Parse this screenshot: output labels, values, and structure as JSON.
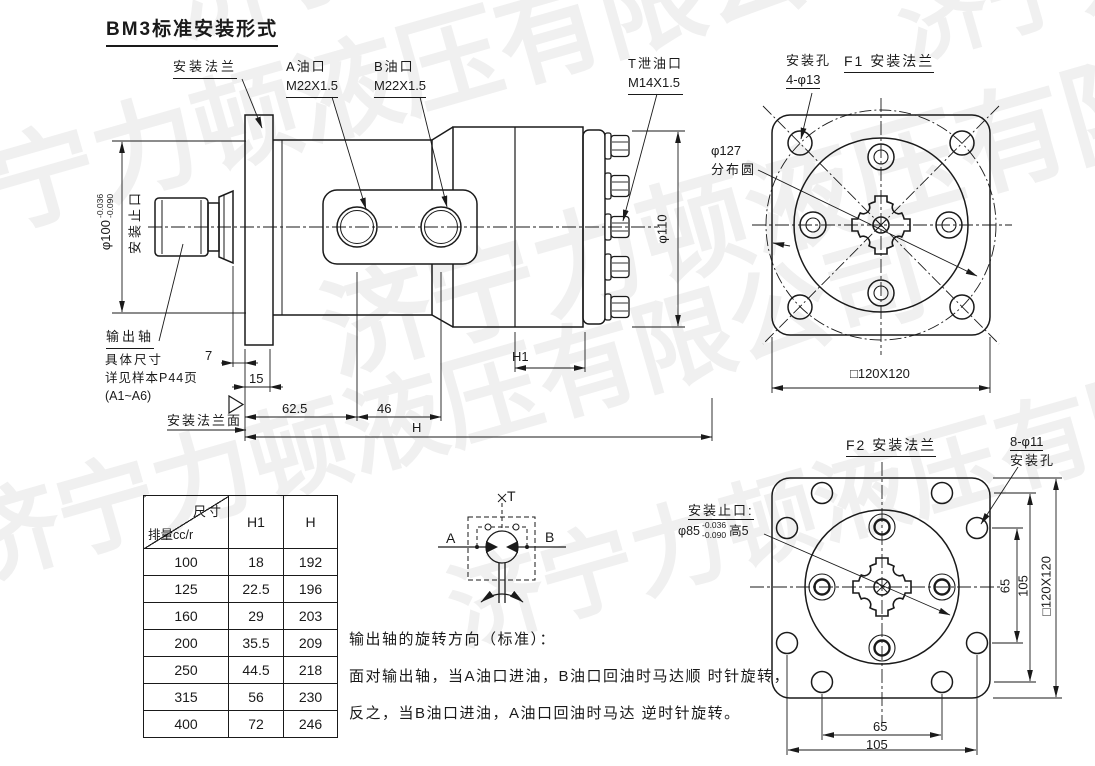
{
  "title": "BM3标准安装形式",
  "watermark": {
    "text": "济宁力顿液压有限公司"
  },
  "side_view": {
    "mount_flange": "安装法兰",
    "port_a": "A油口",
    "port_a_thread": "M22X1.5",
    "port_b": "B油口",
    "port_b_thread": "M22X1.5",
    "drain_port": "T泄油口",
    "drain_thread": "M14X1.5",
    "pilot_dia": "φ100",
    "pilot_tol_upper": "-0.036",
    "pilot_tol_lower": "-0.090",
    "pilot_label": "安装止口",
    "output_shaft": "输出轴",
    "shaft_note1": "具体尺寸",
    "shaft_note2": "详见样本P44页",
    "shaft_note3": "(A1~A6)",
    "flange_face": "安装法兰面",
    "body_dia": "φ110",
    "dims": {
      "d7": "7",
      "d15": "15",
      "d62_5": "62.5",
      "d46": "46",
      "h1": "H1",
      "h": "H"
    }
  },
  "f1_view": {
    "title": "F1 安装法兰",
    "holes_label1": "安装孔",
    "holes_label2": "4-φ13",
    "bolt_circle_dia": "φ127",
    "bolt_circle_label": "分布圆",
    "square_dim": "□120X120"
  },
  "f2_view": {
    "title": "F2 安装法兰",
    "holes_label1": "8-φ11",
    "holes_label2": "安装孔",
    "pilot_label": "安装止口:",
    "pilot_dia": "φ85",
    "pilot_tol_upper": "-0.036",
    "pilot_tol_lower": "-0.090",
    "pilot_height": "高5",
    "dim_65_v": "65",
    "dim_105_v": "105",
    "square_dim_v": "□120X120",
    "dim_65_h": "65",
    "dim_105_h": "105"
  },
  "spec_table": {
    "header_top_right": "尺寸",
    "header_bottom_left": "排量cc/r",
    "columns": [
      "H1",
      "H"
    ],
    "rows": [
      [
        "100",
        "18",
        "192"
      ],
      [
        "125",
        "22.5",
        "196"
      ],
      [
        "160",
        "29",
        "203"
      ],
      [
        "200",
        "35.5",
        "209"
      ],
      [
        "250",
        "44.5",
        "218"
      ],
      [
        "315",
        "56",
        "230"
      ],
      [
        "400",
        "72",
        "246"
      ]
    ]
  },
  "schematic": {
    "port_t": "T",
    "port_a": "A",
    "port_b": "B"
  },
  "rotation_note": {
    "line1": "输出轴的旋转方向（标准）：",
    "line2": "面对输出轴，当A油口进油，B油口回油时马达顺 时针旋转，",
    "line3": "反之，当B油口进油，A油口回油时马达 逆时针旋转。"
  }
}
